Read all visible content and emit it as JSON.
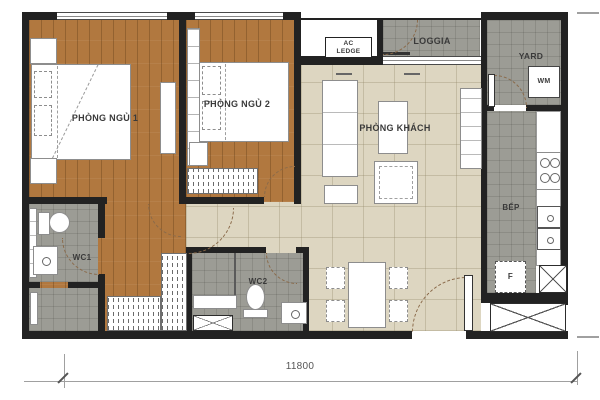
{
  "colors": {
    "wall": "#222222",
    "wood": "#b1783f",
    "woodline": "rgba(84,50,17,0.32)",
    "tile": "#9c9c95",
    "tileline": "rgba(55,55,50,0.16)",
    "beige": "#ddd6c1",
    "beigeline": "rgba(148,138,108,0.35)",
    "furnborder": "#8d8d8d",
    "labeltext": "#3a3a3a",
    "arc": "#8a6a4a",
    "dimline": "#a0a0a0"
  },
  "rooms": {
    "bedroom1": {
      "label": "PHÒNG NGỦ 1"
    },
    "bedroom2": {
      "label": "PHÒNG NGỦ 2"
    },
    "living": {
      "label": "PHÒNG KHÁCH"
    },
    "loggia": {
      "label": "LOGGIA"
    },
    "ac_ledge": {
      "label": "AC LEDGE"
    },
    "yard": {
      "label": "YARD"
    },
    "kitchen": {
      "label": "BẾP"
    },
    "wc1": {
      "label": "WC1"
    },
    "wc2": {
      "label": "WC2"
    }
  },
  "appliances": {
    "washing_machine": {
      "label": "WM"
    },
    "fridge": {
      "label": "F"
    }
  },
  "dimensions": {
    "overall_width": "11800"
  }
}
